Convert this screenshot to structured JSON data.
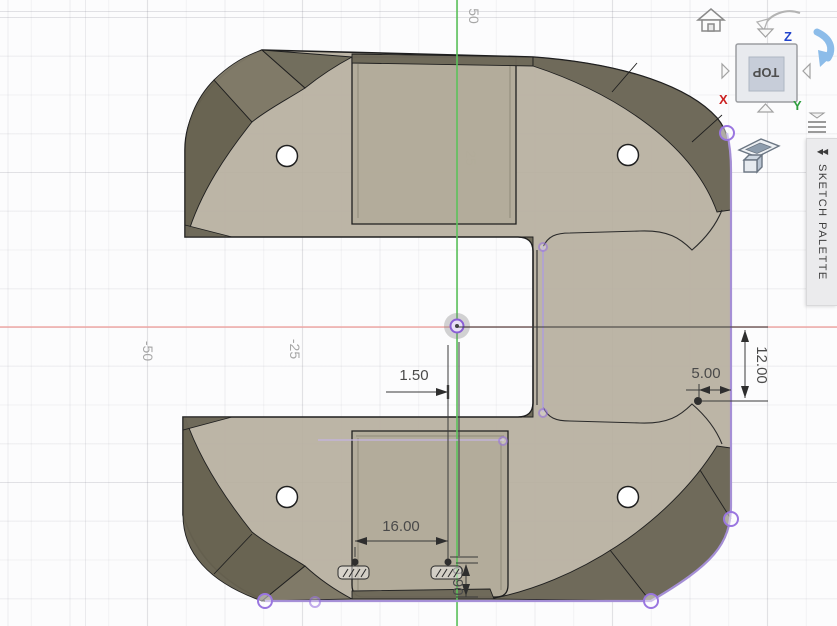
{
  "canvas": {
    "grid_labels": {
      "x_neg50": "-50",
      "x_neg25": "-25",
      "y_25": "25",
      "y_50": "50"
    }
  },
  "axes": {
    "x_letter": "X",
    "y_letter": "Y",
    "z_letter": "Z"
  },
  "viewcube": {
    "face_label": "TOP"
  },
  "panel": {
    "title": "SKETCH PALETTE",
    "collapse_glyph": "◀◀"
  },
  "dimensions": {
    "offset_1_50": "1.50",
    "slot_width_16_00": "16.00",
    "slot_height_0_90": "0.90",
    "edge_offset_5_00": "5.00",
    "point_height_12_00": "12.00"
  },
  "icons": {
    "home": "home-icon",
    "orbit": "orbit-arrow-icon",
    "rotate": "rotate-arrow-icon",
    "viewcube_arrows": "viewcube-rotate-arrows",
    "menu": "viewcube-menu-icon",
    "sketch_plane": "sketch-plane-icon",
    "fixed_constraint": "fixed-constraint-icon",
    "origin": "origin-marker"
  },
  "colors": {
    "body_face": "#b7af9d",
    "pocket_face": "#b1a996",
    "bevel": "#6c6757",
    "bevel_light": "#7e7866",
    "edge": "#1f1f1f",
    "selection": "#9a76e0",
    "selection_line": "#ab93de",
    "x_axis": "#efa9a7",
    "y_axis": "#5cc25c",
    "dimension": "#3a3a3a"
  }
}
